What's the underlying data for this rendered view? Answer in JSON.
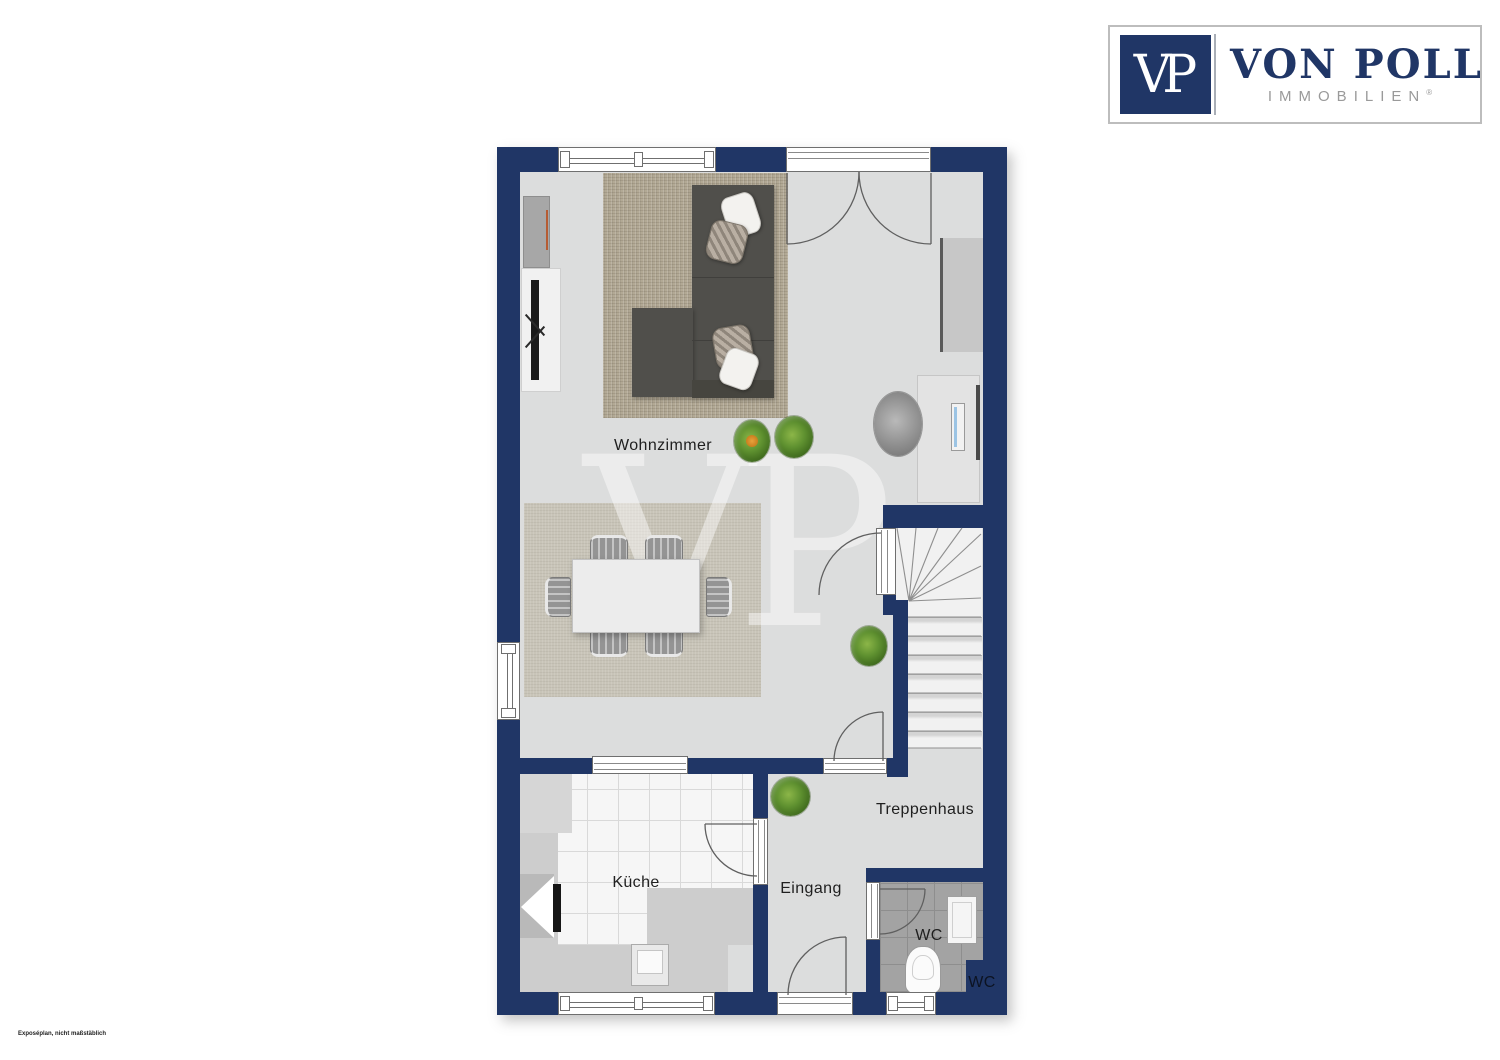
{
  "logo": {
    "vp_initials": "VP",
    "brand": "VON POLL",
    "brand_sub": "IMMOBILIEN",
    "registered_mark": "®"
  },
  "watermark": {
    "text": "VP"
  },
  "disclaimer": {
    "text": "Exposéplan, nicht maßstäblich"
  },
  "floorplan": {
    "rooms": {
      "living": "Wohnzimmer",
      "kitchen": "Küche",
      "entry": "Eingang",
      "staircase": "Treppenhaus",
      "wc": "WC",
      "wc_outer": "WC"
    },
    "colors": {
      "wall_navy": "#203666",
      "floor_gray": "#dcdddd",
      "kitchen_tile": "#f6f6f6",
      "wc_tile": "#a3a3a3",
      "living_rug": "#b2a995",
      "dining_rug": "#c8c4b8",
      "sofa": "#504f4b",
      "plant_green": "#5f9130",
      "brand_navy": "#203666"
    }
  }
}
